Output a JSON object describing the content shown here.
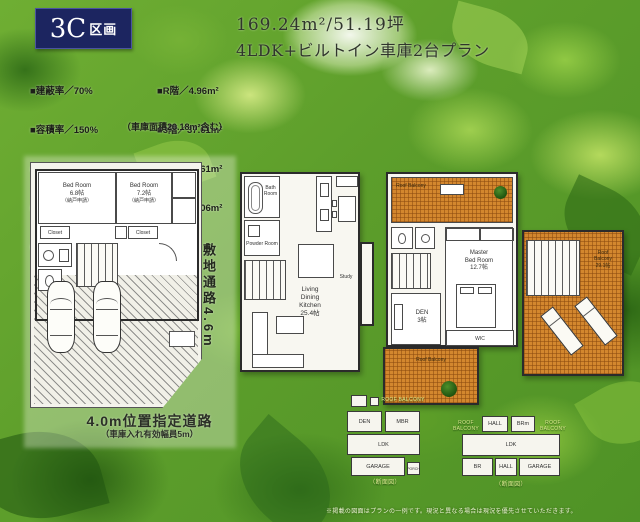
{
  "badge": {
    "big": "3C",
    "small": "区画"
  },
  "title": {
    "line1": "169.24m²/51.19坪",
    "line2": "4LDK+ビルトイン車庫2台プラン"
  },
  "specs": {
    "left": [
      "■建蔽率／70%",
      "■容積率／150%",
      "■土地面積／99.16m²",
      "■建築面積／66.61m²",
      "■延床面積／169.24m²"
    ],
    "right": [
      "■R階／4.96m²",
      "■3階／37.61m²",
      "■2階／66.61m²",
      "■1階／60.06m²"
    ],
    "note": "（車庫面積20.18m²含む）"
  },
  "plan1": {
    "bedroom1": {
      "name": "Bed Room",
      "size": "6.8帖",
      "sub": "（納戸申請）"
    },
    "bedroom2": {
      "name": "Bed Room",
      "size": "7.2帖",
      "sub": "（納戸申請）"
    },
    "closet1": "Closet",
    "closet2": "Closet",
    "passage_label": "敷地通路4.6m",
    "road_label": "4.0m位置指定道路",
    "road_note": "（車庫入れ有効幅員5m）"
  },
  "plan2": {
    "bath": "Bath Room",
    "powder": "Powder Room",
    "study": "Study",
    "ldk": {
      "l1": "Living",
      "l2": "Dining",
      "l3": "Kitchen",
      "size": "25.4帖"
    }
  },
  "plan3": {
    "balcony_top": "Roof Balcony",
    "master": {
      "l1": "Master",
      "l2": "Bed Room",
      "size": "12.7帖"
    },
    "wic": "WIC",
    "den": {
      "name": "DEN",
      "size": "3帖"
    },
    "balcony_bottom": "Roof Balcony"
  },
  "roof": {
    "l1": "Roof",
    "l2": "Balcony",
    "size": "29.1帖"
  },
  "sectionA": {
    "roof_label": "ROOF BALCONY",
    "den": "DEN",
    "mbr": "MBR",
    "ldk": "LDK",
    "garage": "GARAGE",
    "porch": "PORCH",
    "caption": "（断面図）"
  },
  "sectionB": {
    "left_label": "ROOF BALCONY",
    "right_label": "ROOF BALCONY",
    "hall1": "HALL",
    "brm": "BRm",
    "ldk": "LDK",
    "br": "BR",
    "hall2": "HALL",
    "garage": "GARAGE",
    "caption": "（断面図）"
  },
  "footer": {
    "disclaimer": "※掲載の図面はプランの一例です。現況と異なる場合は現況を優先させていただきます。"
  }
}
